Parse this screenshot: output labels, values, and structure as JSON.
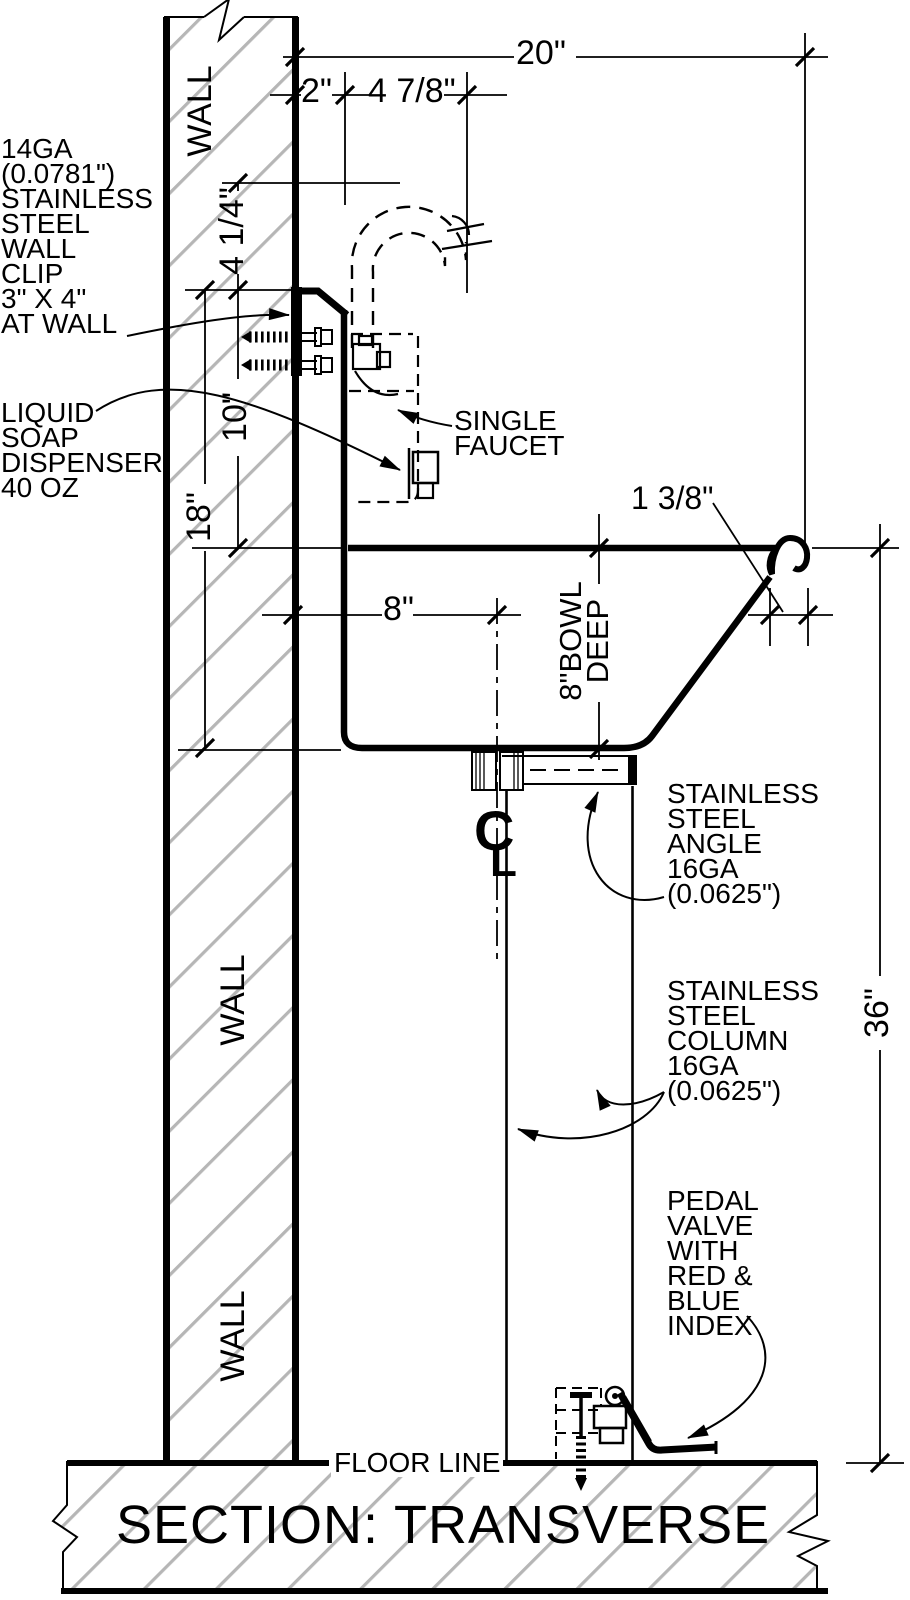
{
  "title": {
    "text": "SECTION: TRANSVERSE"
  },
  "wall": {
    "label_top": "WALL",
    "label_middle": "WALL",
    "label_bottom": "WALL"
  },
  "floor": {
    "label": "FLOOR LINE"
  },
  "dimensions": {
    "total_depth": "20\"",
    "backsplash_setback": "2\"",
    "faucet_center": "4 7/8\"",
    "clip_drop": "4 1/4\"",
    "clip_to_rim": "10\"",
    "rim_to_bowl_bottom": "18\"",
    "drain_center": "8\"",
    "bowl_depth": [
      "8\"BOWL",
      "DEEP"
    ],
    "rim_roll": "1 3/8\"",
    "rim_height": "36\""
  },
  "callouts": {
    "wall_clip": {
      "lines": [
        "14GA",
        "(0.0781\")",
        "STAINLESS",
        "STEEL",
        "WALL",
        "CLIP",
        "3\" X 4\"",
        "AT WALL"
      ]
    },
    "soap_dispenser": {
      "lines": [
        "LIQUID",
        "SOAP",
        "DISPENSER",
        "40 OZ"
      ]
    },
    "single_faucet": {
      "lines": [
        "SINGLE",
        "FAUCET"
      ]
    },
    "steel_angle": {
      "lines": [
        "STAINLESS",
        "STEEL",
        "ANGLE",
        "16GA",
        "(0.0625\")"
      ]
    },
    "steel_column": {
      "lines": [
        "STAINLESS",
        "STEEL",
        "COLUMN",
        "16GA",
        "(0.0625\")"
      ]
    },
    "pedal_valve": {
      "lines": [
        "PEDAL",
        "VALVE",
        "WITH",
        "RED &",
        "BLUE",
        "INDEX"
      ]
    }
  },
  "centerline_symbol": {
    "c": "C",
    "l": "L"
  },
  "colors": {
    "line": "#000000",
    "hatch": "#b6b6b6",
    "background": "#ffffff"
  }
}
